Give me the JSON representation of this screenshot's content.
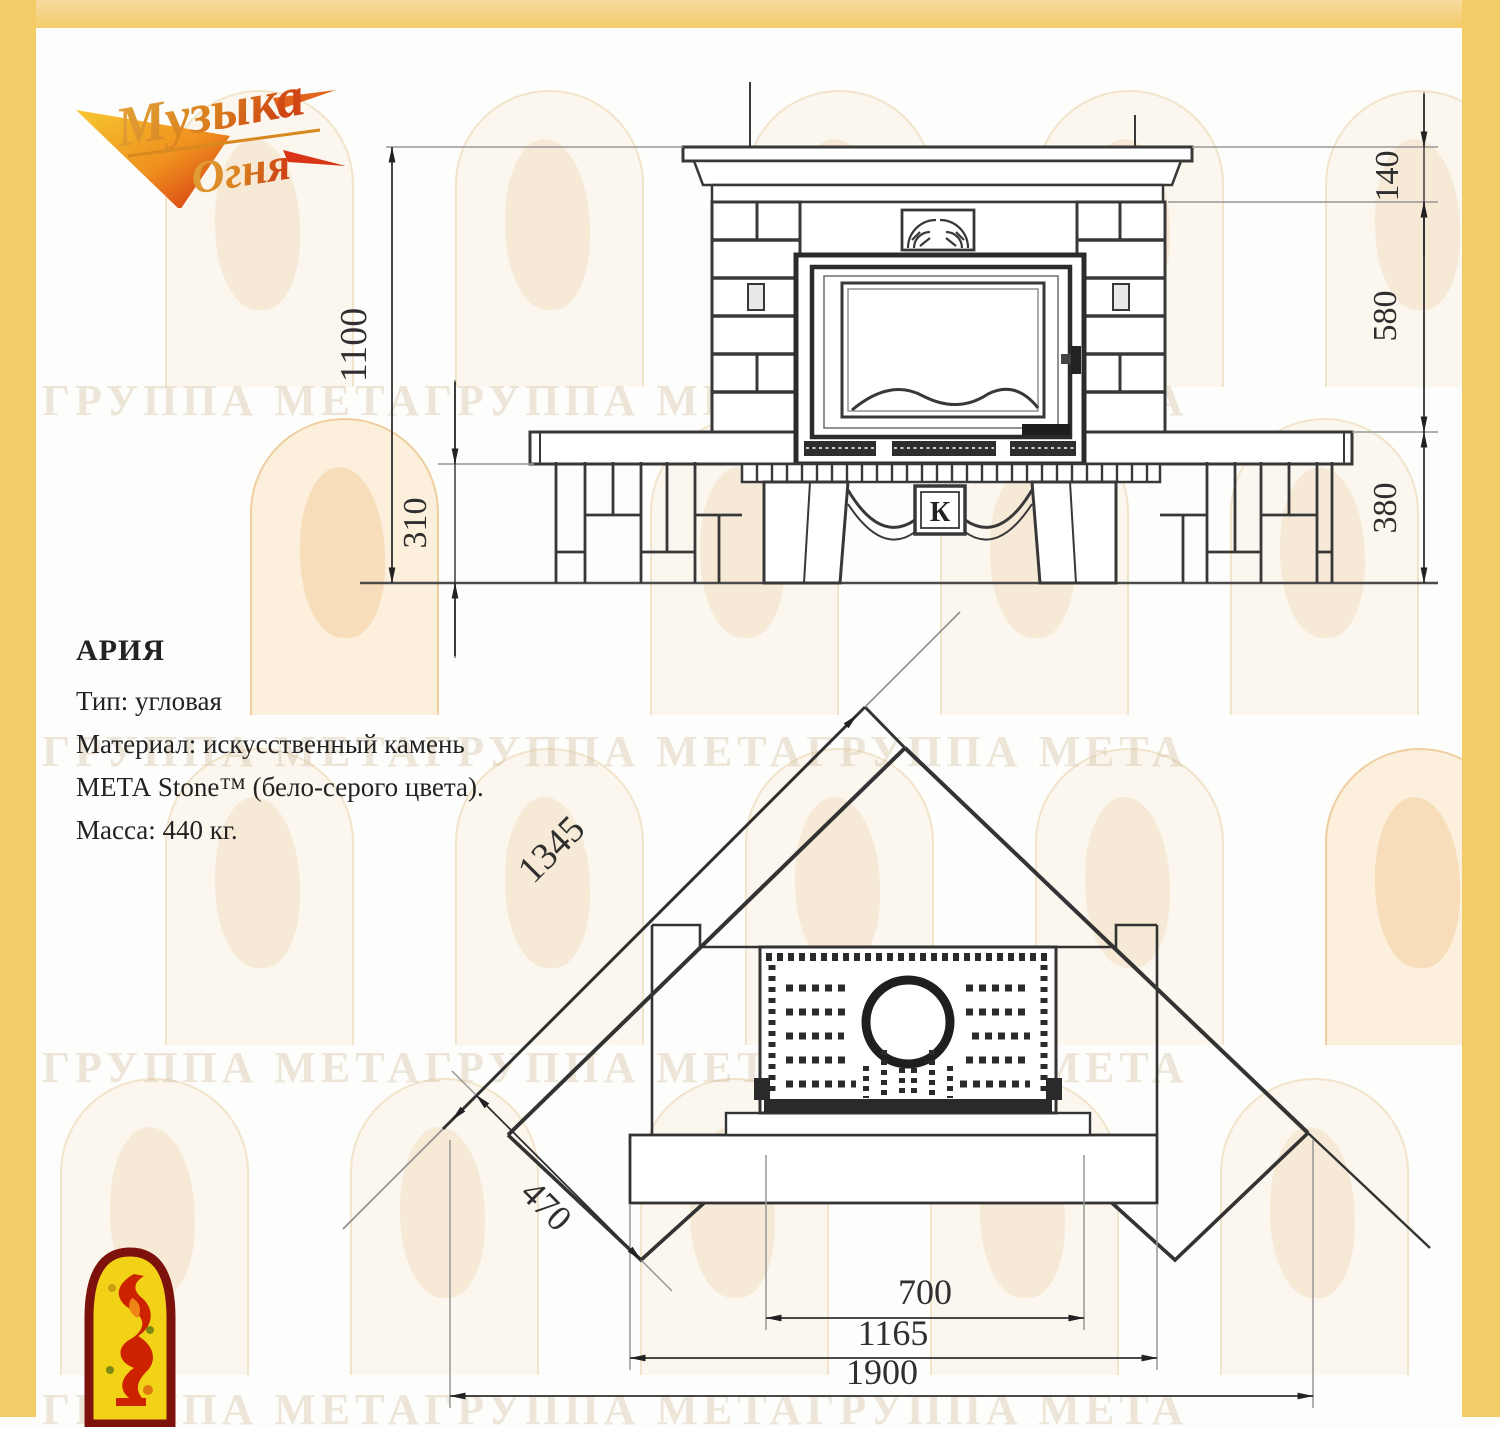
{
  "brand": {
    "logo_line1": "Музыка",
    "logo_line2": "Огня"
  },
  "info": {
    "title": "АРИЯ",
    "lines": [
      "Тип: угловая",
      "Материал: искусственный камень",
      "МЕТА Stone™ (бело-серого цвета).",
      "Масса: 440 кг."
    ]
  },
  "front_view": {
    "dims": {
      "total_height": "1100",
      "bench_height": "310",
      "crown_height": "140",
      "middle_height": "580",
      "base_height": "380"
    },
    "emblem_letter": "К"
  },
  "plan_view": {
    "dims": {
      "wall_side": "1345",
      "corner_depth": "470",
      "opening_width": "700",
      "base_width": "1165",
      "total_width": "1900"
    }
  },
  "watermark": {
    "text": "ГРУППА МЕТАГРУППА МЕТАГРУППА МЕТА"
  },
  "colors": {
    "frame_yellow": "#f3cc68",
    "logo_orange": "#df8a1f",
    "logo_red": "#cf2a12",
    "arch_yellow": "#f2d216",
    "arch_red": "#7d120d",
    "line_dark": "#383838"
  }
}
